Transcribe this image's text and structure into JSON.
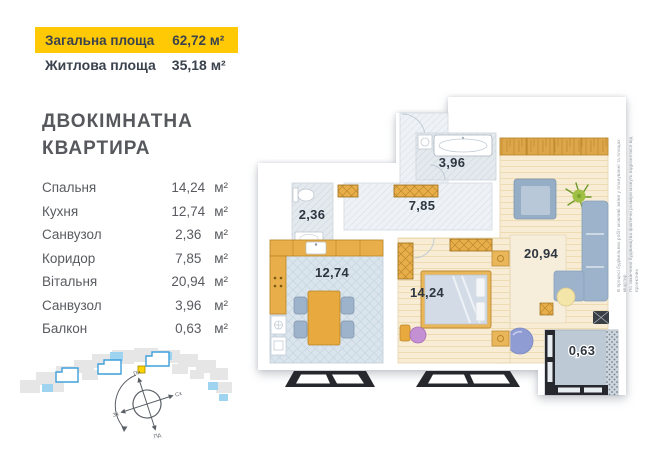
{
  "header": {
    "total_area_label": "Загальна площа",
    "total_area_value": "62,72 м²",
    "living_area_label": "Житлова площа",
    "living_area_value": "35,18 м²"
  },
  "title": {
    "line1": "ДВОКІМНАТНА",
    "line2": "КВАРТИРА"
  },
  "rooms": [
    {
      "name": "Спальня",
      "value": "14,24",
      "unit": "м²"
    },
    {
      "name": "Кухня",
      "value": "12,74",
      "unit": "м²"
    },
    {
      "name": "Санвузол",
      "value": "2,36",
      "unit": "м²"
    },
    {
      "name": "Коридор",
      "value": "7,85",
      "unit": "м²"
    },
    {
      "name": "Вітальня",
      "value": "20,94",
      "unit": "м²"
    },
    {
      "name": "Санвузол",
      "value": "3,96",
      "unit": "м²"
    },
    {
      "name": "Балкон",
      "value": "0,63",
      "unit": "м²"
    }
  ],
  "floorplan": {
    "labels": {
      "bathroom_small": "2,36",
      "corridor": "7,85",
      "bathroom_large": "3,96",
      "kitchen": "12,74",
      "bedroom": "14,24",
      "living_room": "20,94",
      "balcony": "0,63"
    }
  },
  "compass": {
    "north": "Пн",
    "south": "Пд",
    "west": "Зх",
    "east": "Сх"
  },
  "disclaimer": {
    "line1": "В процесі будівельних робіт можливі зміни у плануванні та площах квартир",
    "line2": "По закінченні будівництва фактичні розміри можуть відрізнятися від проектних"
  },
  "colors": {
    "banner_bg": "#FFCA05",
    "text_dark": "#3A424D",
    "wood_floor": "#F8ECD4",
    "tile_floor": "#D9E4EC",
    "furniture_orange": "#E8A93F",
    "furniture_blue": "#9FB4CC",
    "window_frame": "#26282E",
    "minimap_blue": "#9FD4F1",
    "marker_yellow": "#FFD400"
  }
}
